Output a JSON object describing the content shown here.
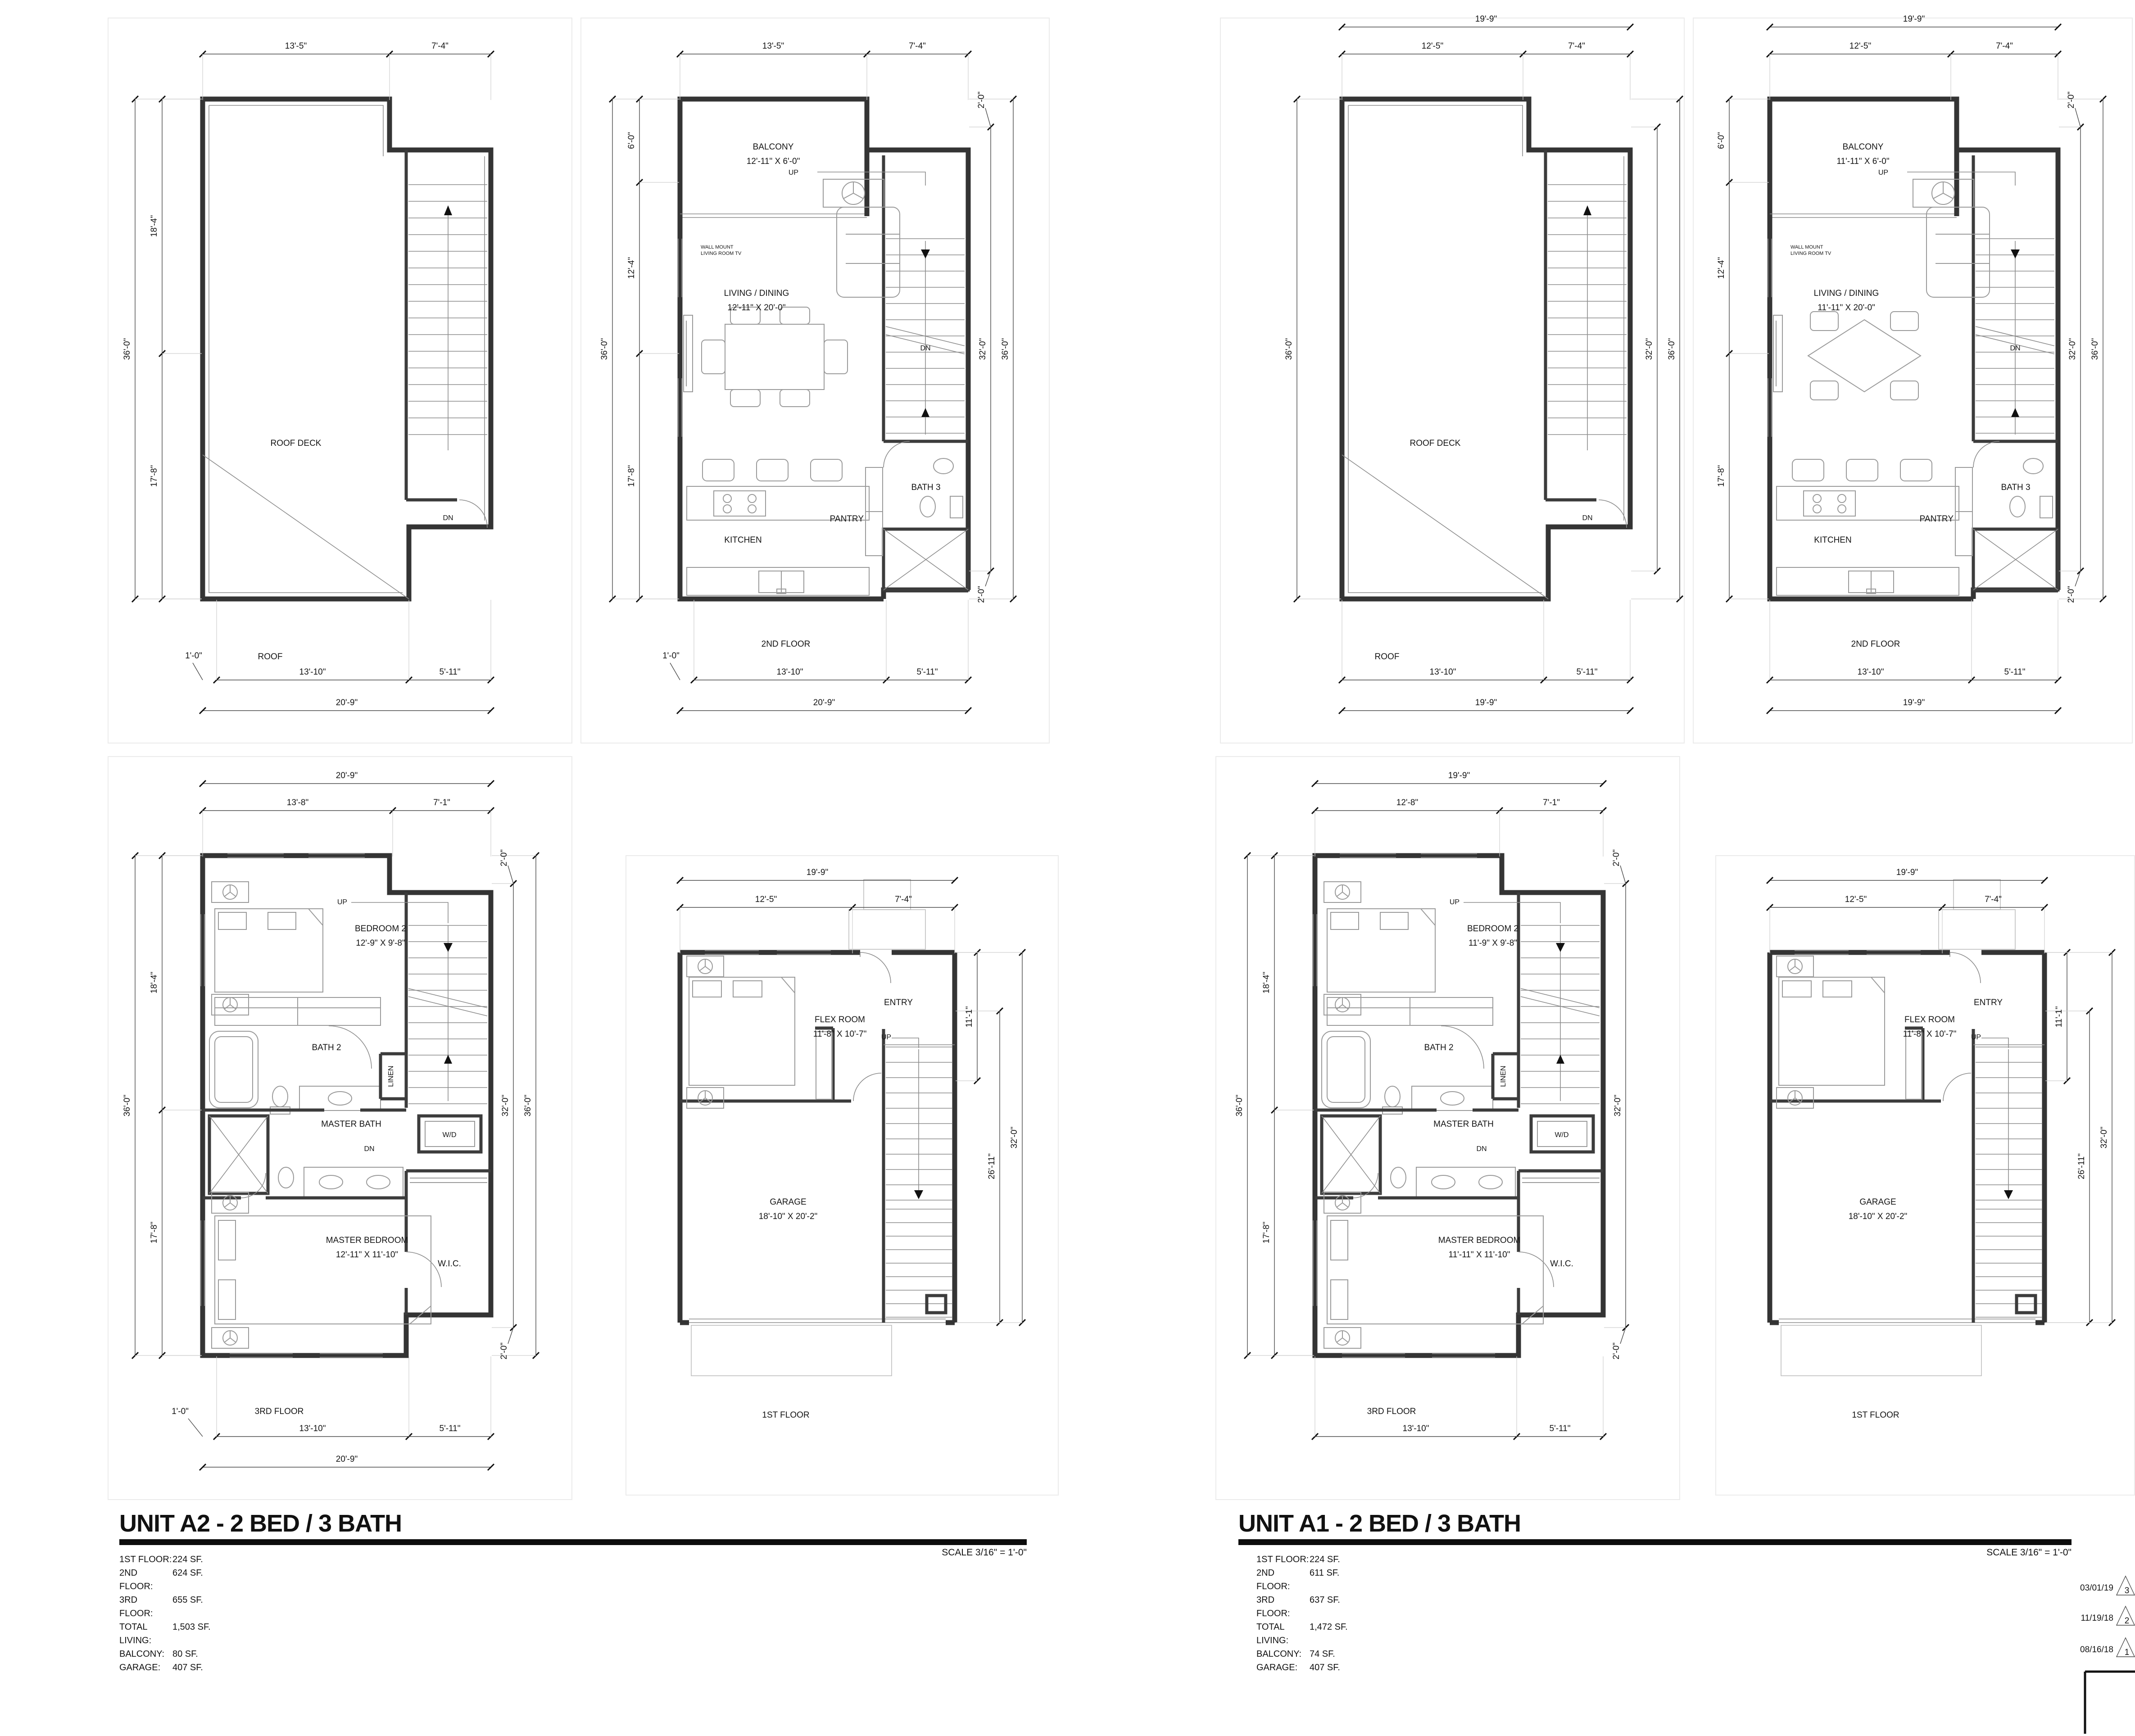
{
  "sheet": {
    "scale_note": "SCALE 3/16\" = 1'-0\"",
    "revisions": [
      {
        "date": "03/01/19",
        "num": "3"
      },
      {
        "date": "11/19/18",
        "num": "2"
      },
      {
        "date": "08/16/18",
        "num": "1"
      }
    ]
  },
  "units": {
    "a2": {
      "title": "UNIT A2 - 2 BED / 3 BATH",
      "areas": [
        {
          "label": "1ST FLOOR:",
          "value": "224 SF."
        },
        {
          "label": "2ND FLOOR:",
          "value": "624 SF."
        },
        {
          "label": "3RD FLOOR:",
          "value": "655 SF."
        },
        {
          "label": "TOTAL LIVING:",
          "value": "1,503 SF."
        },
        {
          "label": "BALCONY:",
          "value": "80 SF."
        },
        {
          "label": "GARAGE:",
          "value": "407 SF."
        }
      ],
      "plans": {
        "roof": {
          "name": "ROOF",
          "room": "ROOF DECK",
          "dn": "DN",
          "top": [
            "13'-5\"",
            "7'-4\""
          ],
          "left_outer": "36'-0\"",
          "left": [
            "18'-4\"",
            "17'-8\""
          ],
          "offset": "1'-0\"",
          "bottom": [
            "13'-10\"",
            "5'-11\""
          ],
          "overall": "20'-9\""
        },
        "second": {
          "name": "2ND FLOOR",
          "up": "UP",
          "dn": "DN",
          "top": [
            "13'-5\"",
            "7'-4\""
          ],
          "left": [
            "6'-0\"",
            "12'-4\"",
            "17'-8\""
          ],
          "left_outer": "36'-0\"",
          "right": [
            "32'-0\"",
            "36'-0\""
          ],
          "right_top": "2'-0\"",
          "right_bottom": "2'-0\"",
          "offset": "1'-0\"",
          "bottom": [
            "13'-10\"",
            "5'-11\""
          ],
          "overall": "20'-9\"",
          "balcony": "BALCONY",
          "balcony_dims": "12'-11\" X 6'-0\"",
          "tv1": "WALL MOUNT",
          "tv2": "LIVING ROOM TV",
          "living": "LIVING / DINING",
          "living_dims": "12'-11\" X 20'-0\"",
          "kitchen": "KITCHEN",
          "pantry": "PANTRY",
          "bath3": "BATH 3"
        },
        "third": {
          "name": "3RD FLOOR",
          "up": "UP",
          "dn": "DN",
          "top_overall": "20'-9\"",
          "top": [
            "13'-8\"",
            "7'-1\""
          ],
          "left_outer": "36'-0\"",
          "left": [
            "18'-4\"",
            "17'-8\""
          ],
          "right": [
            "32'-0\"",
            "36'-0\""
          ],
          "right_top": "2'-0\"",
          "right_bottom": "2'-0\"",
          "offset": "1'-0\"",
          "bottom": [
            "13'-10\"",
            "5'-11\""
          ],
          "overall": "20'-9\"",
          "bedroom2": "BEDROOM 2",
          "bedroom2_dims": "12'-9\" X 9'-8\"",
          "bath2": "BATH 2",
          "linen": "LINEN",
          "master_bath": "MASTER BATH",
          "wd": "W/D",
          "master_bedroom": "MASTER BEDROOM",
          "master_bedroom_dims": "12'-11\" X 11'-10\"",
          "wic": "W.I.C."
        },
        "first": {
          "name": "1ST FLOOR",
          "up": "UP",
          "top_overall": "19'-9\"",
          "top": [
            "12'-5\"",
            "7'-4\""
          ],
          "right": [
            "11'-1\"",
            "26'-11\"",
            "32'-0\""
          ],
          "flex": "FLEX ROOM",
          "flex_dims": "11'-8\" X 10'-7\"",
          "entry": "ENTRY",
          "garage": "GARAGE",
          "garage_dims": "18'-10\" X 20'-2\""
        }
      }
    },
    "a1": {
      "title": "UNIT A1 - 2 BED / 3 BATH",
      "areas": [
        {
          "label": "1ST FLOOR:",
          "value": "224 SF."
        },
        {
          "label": "2ND FLOOR:",
          "value": "611 SF."
        },
        {
          "label": "3RD FLOOR:",
          "value": "637 SF."
        },
        {
          "label": "TOTAL LIVING:",
          "value": "1,472 SF."
        },
        {
          "label": "BALCONY:",
          "value": "74 SF."
        },
        {
          "label": "GARAGE:",
          "value": "407 SF."
        }
      ],
      "plans": {
        "roof": {
          "name": "ROOF",
          "room": "ROOF DECK",
          "dn": "DN",
          "top_overall": "19'-9\"",
          "top": [
            "12'-5\"",
            "7'-4\""
          ],
          "left_outer": "36'-0\"",
          "right": [
            "32'-0\"",
            "36'-0\""
          ],
          "bottom": [
            "13'-10\"",
            "5'-11\""
          ],
          "overall": "19'-9\""
        },
        "second": {
          "name": "2ND FLOOR",
          "up": "UP",
          "dn": "DN",
          "top_overall": "19'-9\"",
          "top": [
            "12'-5\"",
            "7'-4\""
          ],
          "left": [
            "6'-0\"",
            "12'-4\"",
            "17'-8\""
          ],
          "right": [
            "32'-0\"",
            "36'-0\""
          ],
          "right_top": "2'-0\"",
          "right_bottom": "2'-0\"",
          "bottom": [
            "13'-10\"",
            "5'-11\""
          ],
          "overall": "19'-9\"",
          "balcony": "BALCONY",
          "balcony_dims": "11'-11\" X 6'-0\"",
          "tv1": "WALL MOUNT",
          "tv2": "LIVING ROOM TV",
          "living": "LIVING / DINING",
          "living_dims": "11'-11\" X 20'-0\"",
          "kitchen": "KITCHEN",
          "pantry": "PANTRY",
          "bath3": "BATH 3"
        },
        "third": {
          "name": "3RD FLOOR",
          "up": "UP",
          "dn": "DN",
          "top_overall": "19'-9\"",
          "top": [
            "12'-8\"",
            "7'-1\""
          ],
          "left_outer": "36'-0\"",
          "left": [
            "18'-4\"",
            "17'-8\""
          ],
          "right": [
            "32'-0\""
          ],
          "right_top": "2'-0\"",
          "right_bottom": "2'-0\"",
          "bottom": [
            "13'-10\"",
            "5'-11\""
          ],
          "bedroom2": "BEDROOM 2",
          "bedroom2_dims": "11'-9\" X 9'-8\"",
          "bath2": "BATH 2",
          "linen": "LINEN",
          "master_bath": "MASTER BATH",
          "wd": "W/D",
          "master_bedroom": "MASTER BEDROOM",
          "master_bedroom_dims": "11'-11\" X 11'-10\"",
          "wic": "W.I.C."
        },
        "first": {
          "name": "1ST FLOOR",
          "up": "UP",
          "top_overall": "19'-9\"",
          "top": [
            "12'-5\"",
            "7'-4\""
          ],
          "right": [
            "11'-1\"",
            "26'-11\"",
            "32'-0\""
          ],
          "flex": "FLEX ROOM",
          "flex_dims": "11'-8\" X 10'-7\"",
          "entry": "ENTRY",
          "garage": "GARAGE",
          "garage_dims": "18'-10\" X 20'-2\""
        }
      }
    }
  }
}
